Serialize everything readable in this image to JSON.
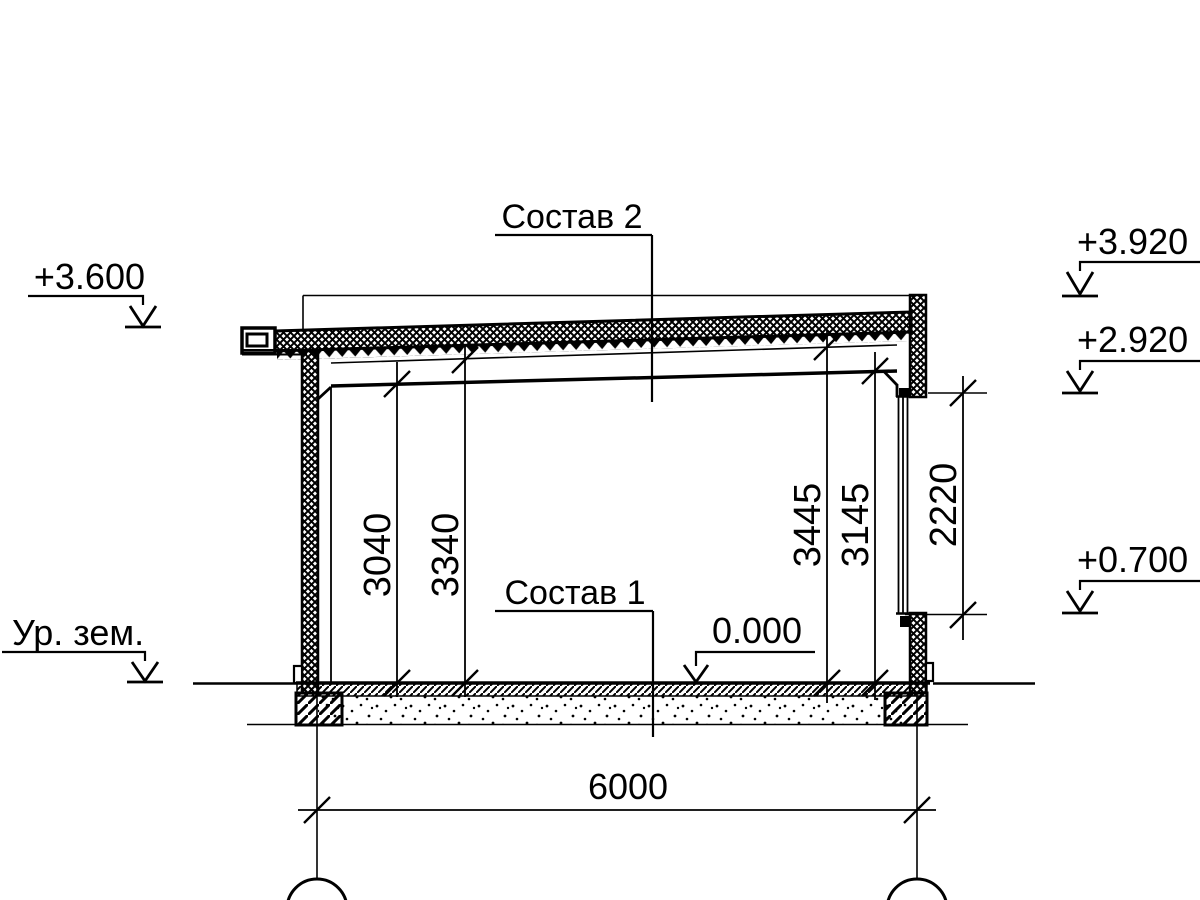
{
  "drawing": {
    "title_labels": {
      "composition_2": "Состав 2",
      "composition_1": "Состав 1",
      "ground_level": "Ур. зем."
    },
    "elevation_marks": {
      "roof_eave": "+3.600",
      "parapet_top": "+3.920",
      "window_head": "+2.920",
      "window_sill": "+0.700",
      "floor_zero": "0.000"
    },
    "dimensions": {
      "ceiling_height_left": "3040",
      "roof_underside_left": "3340",
      "roof_underside_right": "3445",
      "ceiling_height_right": "3145",
      "window_opening": "2220",
      "axis_span": "6000"
    },
    "colors": {
      "ink": "#000000",
      "paper": "#ffffff"
    }
  }
}
